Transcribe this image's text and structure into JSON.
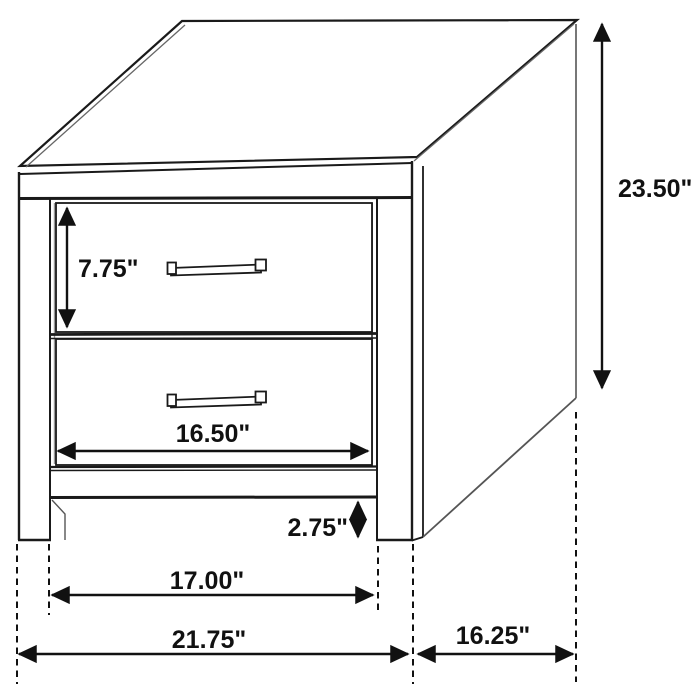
{
  "diagram": {
    "subject": "two-drawer nightstand technical line drawing with dimension callouts",
    "units": "inches",
    "background_color": "#ffffff",
    "line_color": "#1a1a1a",
    "dimensions": {
      "drawer_height": {
        "label": "7.75\"",
        "value": 7.75,
        "orientation": "vertical"
      },
      "drawer_width": {
        "label": "16.50\"",
        "value": 16.5,
        "orientation": "horizontal"
      },
      "base_clearance": {
        "label": "2.75\"",
        "value": 2.75,
        "orientation": "vertical"
      },
      "inner_leg_span": {
        "label": "17.00\"",
        "value": 17.0,
        "orientation": "horizontal"
      },
      "overall_width": {
        "label": "21.75\"",
        "value": 21.75,
        "orientation": "horizontal"
      },
      "depth": {
        "label": "16.25\"",
        "value": 16.25,
        "orientation": "horizontal"
      },
      "overall_height": {
        "label": "23.50\"",
        "value": 23.5,
        "orientation": "vertical"
      }
    }
  }
}
